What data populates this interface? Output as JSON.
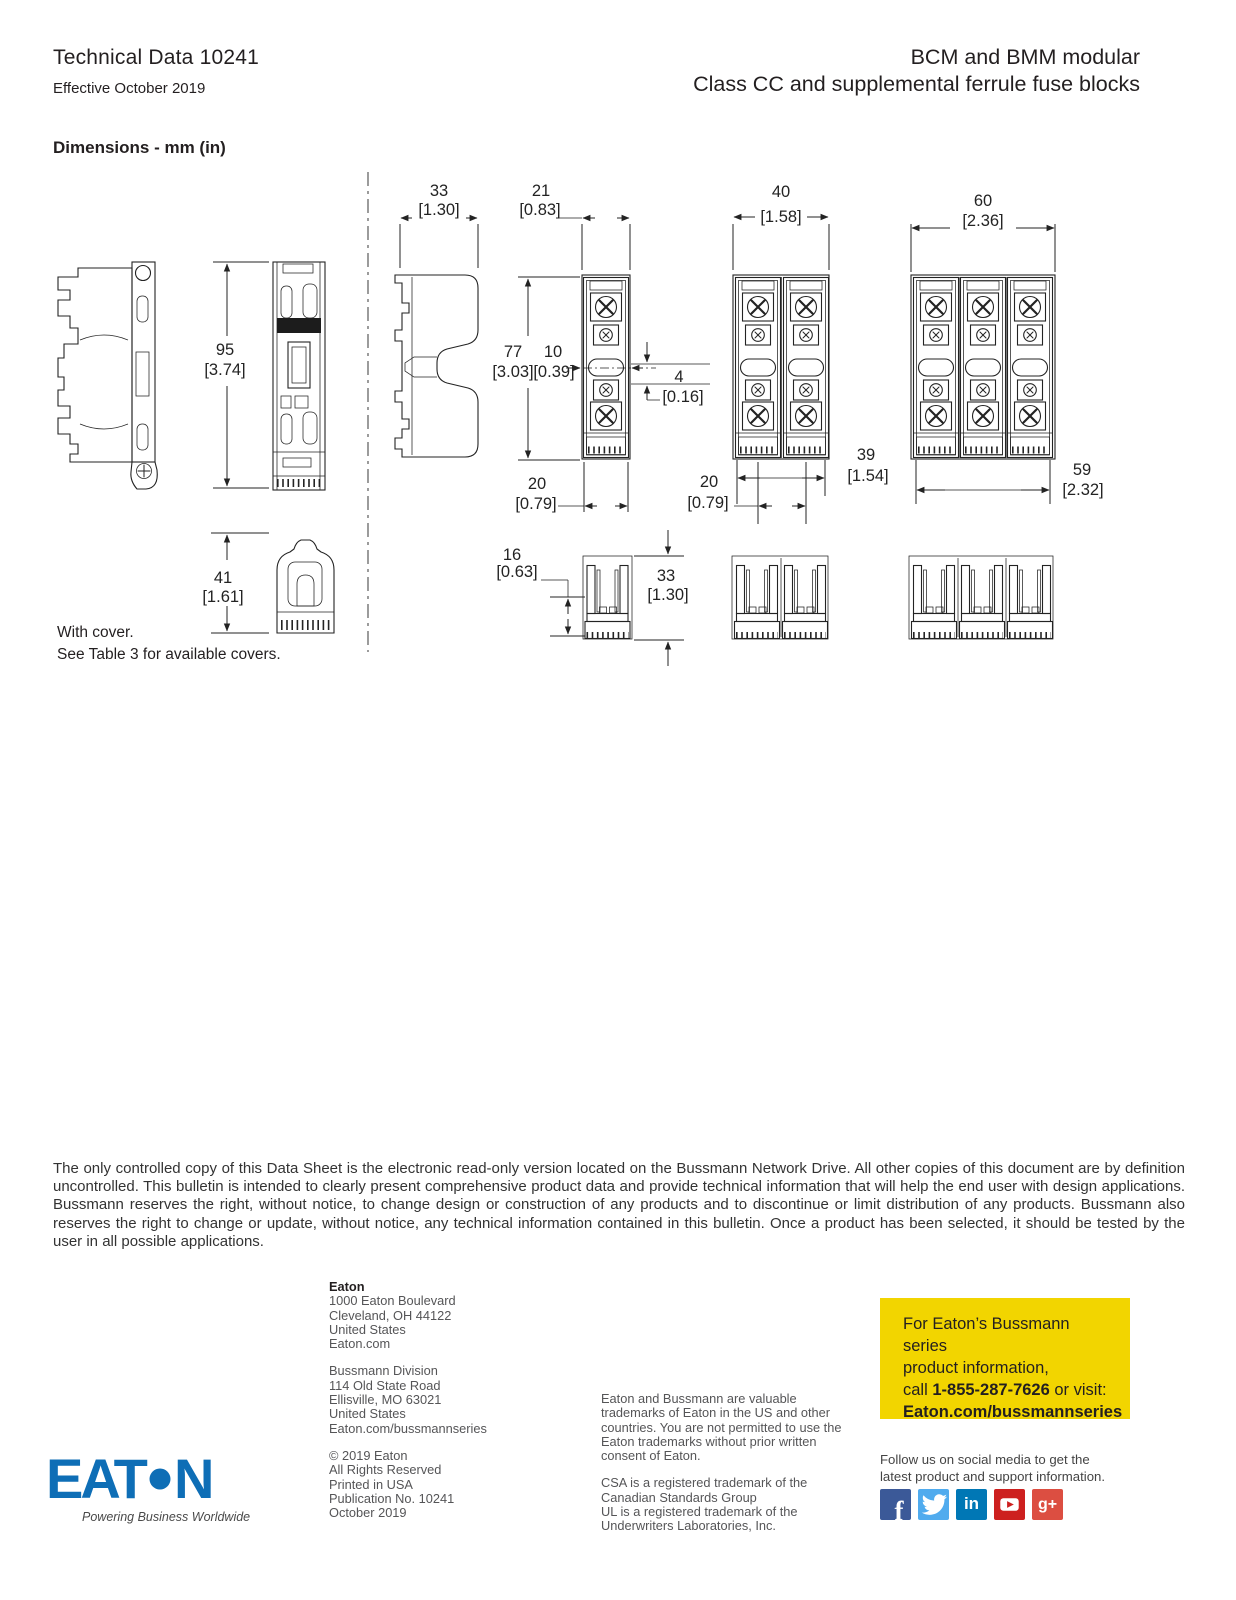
{
  "header": {
    "doc_title": "Technical Data 10241",
    "effective_date": "Effective October 2019",
    "product_title_line1": "BCM and BMM modular",
    "product_title_line2": "Class CC and supplemental ferrule fuse blocks"
  },
  "dimensions": {
    "heading": "Dimensions - mm (in)",
    "cover_note_line1": "With cover.",
    "cover_note_line2": "See Table 3 for available covers.",
    "labels": {
      "height_95": {
        "mm": "95",
        "in": "[3.74]"
      },
      "height_41": {
        "mm": "41",
        "in": "[1.61]"
      },
      "width_33": {
        "mm": "33",
        "in": "[1.30]"
      },
      "width_21": {
        "mm": "21",
        "in": "[0.83]"
      },
      "height_77": {
        "mm": "77",
        "in": "[3.03]"
      },
      "width_10": {
        "mm": "10",
        "in": "[0.39]"
      },
      "height_4": {
        "mm": "4",
        "in": "[0.16]"
      },
      "width_20_single": {
        "mm": "20",
        "in": "[0.79]"
      },
      "width_40": {
        "mm": "40",
        "in": "[1.58]"
      },
      "width_39": {
        "mm": "39",
        "in": "[1.54]"
      },
      "width_20_double": {
        "mm": "20",
        "in": "[0.79]"
      },
      "width_60": {
        "mm": "60",
        "in": "[2.36]"
      },
      "width_59": {
        "mm": "59",
        "in": "[2.32]"
      },
      "height_16": {
        "mm": "16",
        "in": "[0.63]"
      },
      "height_33_cover": {
        "mm": "33",
        "in": "[1.30]"
      }
    }
  },
  "disclaimer": "The only controlled copy of this Data Sheet is the electronic read-only version located on the Bussmann Network Drive. All other copies of this document are by definition uncontrolled. This bulletin is intended to clearly present comprehensive product data and provide technical information that will help the end user with design applications. Bussmann reserves the right, without notice, to change design or construction of any products and to discontinue or limit distribution of any products. Bussmann also reserves the right to change or update, without notice, any technical information contained in this bulletin. Once a product has been selected, it should be tested by the user in all possible applications.",
  "footer": {
    "eaton_hq": {
      "name": "Eaton",
      "address_line1": "1000 Eaton Boulevard",
      "address_line2": "Cleveland, OH 44122",
      "address_line3": "United States",
      "website": "Eaton.com"
    },
    "bussmann_division": {
      "name": "Bussmann Division",
      "address_line1": "114 Old State Road",
      "address_line2": "Ellisville, MO 63021",
      "address_line3": "United States",
      "website": "Eaton.com/bussmannseries"
    },
    "copyright": {
      "line1": "© 2019 Eaton",
      "line2": "All Rights Reserved",
      "line3": "Printed in USA",
      "line4": "Publication No. 10241",
      "line5": "October 2019"
    },
    "trademarks_para1": "Eaton and Bussmann are valuable trademarks of Eaton in the US and other countries. You are not permitted to use the Eaton trademarks without prior written consent of Eaton.",
    "trademarks_para2": "CSA is a registered trademark of the Canadian Standards Group",
    "trademarks_para3": "UL is a registered trademark of the Underwriters Laboratories, Inc.",
    "promo": {
      "line1": "For Eaton’s Bussmann series",
      "line2": "product information,",
      "call_prefix": "call ",
      "phone": "1-855-287-7626",
      "call_suffix": " or visit:",
      "website": "Eaton.com/bussmannseries",
      "bg_color": "#f2d500"
    },
    "social": {
      "line1": "Follow us on social media to get the",
      "line2": "latest product and support information.",
      "icons": [
        {
          "name": "facebook",
          "glyph": "f",
          "color": "#3b5998"
        },
        {
          "name": "twitter",
          "glyph": "",
          "color": "#50abee"
        },
        {
          "name": "linkedin",
          "glyph": "in",
          "color": "#0077b5"
        },
        {
          "name": "youtube",
          "glyph": "",
          "color": "#cd201f"
        },
        {
          "name": "google-plus",
          "glyph": "g+",
          "color": "#dc4e41"
        }
      ]
    },
    "logo": {
      "brand": "EAT•N",
      "tagline": "Powering Business Worldwide",
      "color": "#0e6eb6"
    }
  }
}
